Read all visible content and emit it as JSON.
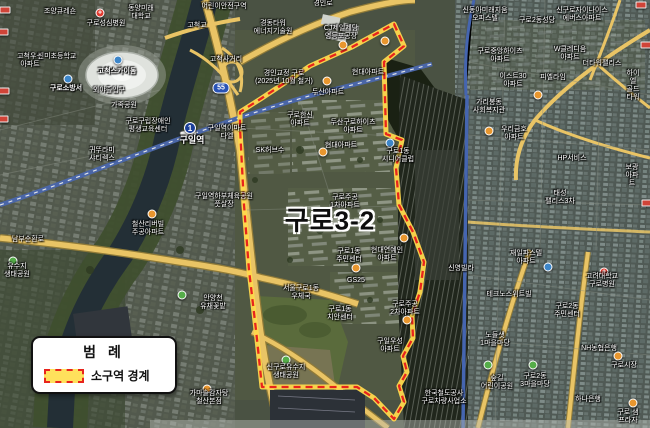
{
  "legend": {
    "title": "범 례",
    "boundary_label": "소구역 경계"
  },
  "map": {
    "area_label": "구로3-2",
    "area_label_pos": {
      "x": 330,
      "y": 219
    },
    "subway_badge": "1",
    "route_badge": "55",
    "hospital_glyph": "+",
    "colors": {
      "boundary_red": "#e8241c",
      "boundary_yellow": "#ffd94d",
      "legend_swatch": "#ffe15c",
      "road_yellow": "#e9c465",
      "railway_blue": "#4a66a8",
      "river": "#232f36"
    },
    "labels": [
      {
        "text": "조양큐레숀",
        "x": 60,
        "y": 8
      },
      {
        "text": "구로성심병원",
        "x": 106,
        "y": 20
      },
      {
        "text": "동양미래\n대학교",
        "x": 141,
        "y": 5
      },
      {
        "text": "고척우성\n아파트",
        "x": 30,
        "y": 53
      },
      {
        "text": "신미초등학교",
        "x": 57,
        "y": 53
      },
      {
        "text": "고척스카이돔",
        "x": 117,
        "y": 68,
        "bold": true
      },
      {
        "text": "구로소방서",
        "x": 66,
        "y": 85,
        "bold": true
      },
      {
        "text": "외야출입구",
        "x": 109,
        "y": 87
      },
      {
        "text": "가족공원",
        "x": 124,
        "y": 102
      },
      {
        "text": "구로구립장애인\n평생교육센터",
        "x": 148,
        "y": 118
      },
      {
        "text": "구일역",
        "x": 192,
        "y": 135,
        "bold": true,
        "size": 9
      },
      {
        "text": "구일역이마트\n다엘",
        "x": 227,
        "y": 125
      },
      {
        "text": "귀뚜라미\n샤티렉스",
        "x": 102,
        "y": 147
      },
      {
        "text": "구일역하부체육공원\n풋살장",
        "x": 224,
        "y": 193
      },
      {
        "text": "남부순환로",
        "x": 28,
        "y": 236
      },
      {
        "text": "유수지\n생태공원",
        "x": 17,
        "y": 263
      },
      {
        "text": "철산리버빌\n주공아파트",
        "x": 148,
        "y": 221
      },
      {
        "text": "안양천\n유채꽃밭",
        "x": 213,
        "y": 295
      },
      {
        "text": "가마솥감자탕\n철산본점",
        "x": 209,
        "y": 390
      },
      {
        "text": "경인로",
        "x": 323,
        "y": 0
      },
      {
        "text": "어린이안전구역",
        "x": 224,
        "y": 3
      },
      {
        "text": "고척교",
        "x": 197,
        "y": 22
      },
      {
        "text": "CJ제일제당\n영등포공장",
        "x": 341,
        "y": 25
      },
      {
        "text": "경동타워\n에너지기술원",
        "x": 273,
        "y": 20
      },
      {
        "text": "고척사거리",
        "x": 226,
        "y": 56
      },
      {
        "text": "경인교정 구로\n(2025년 10월 철거)",
        "x": 284,
        "y": 70
      },
      {
        "text": "두산아파트",
        "x": 328,
        "y": 89
      },
      {
        "text": "구로한신\n아파트",
        "x": 300,
        "y": 112
      },
      {
        "text": "SK허브수",
        "x": 270,
        "y": 147
      },
      {
        "text": "현대아파트",
        "x": 368,
        "y": 69
      },
      {
        "text": "두산구로하이츠\n아파트",
        "x": 353,
        "y": 119
      },
      {
        "text": "현대아파트",
        "x": 341,
        "y": 142
      },
      {
        "text": "구로1동\n시니어클럽",
        "x": 398,
        "y": 148
      },
      {
        "text": "구로주공\n1차아파트",
        "x": 345,
        "y": 194
      },
      {
        "text": "현대연예인\n아파트",
        "x": 387,
        "y": 247
      },
      {
        "text": "구로1동\n주민센터",
        "x": 349,
        "y": 248
      },
      {
        "text": "GS25",
        "x": 356,
        "y": 277
      },
      {
        "text": "서울구로1동\n우체국",
        "x": 301,
        "y": 285
      },
      {
        "text": "구로1동\n치안센터",
        "x": 340,
        "y": 306
      },
      {
        "text": "구로주공\n2차아파트",
        "x": 405,
        "y": 301
      },
      {
        "text": "구일우성\n아파트",
        "x": 390,
        "y": 338
      },
      {
        "text": "신구로유수지\n생태공원",
        "x": 286,
        "y": 364
      },
      {
        "text": "한국철도공사\n구로차량사업소",
        "x": 444,
        "y": 390
      },
      {
        "text": "신동아미래지움\n오피스텔",
        "x": 485,
        "y": 7
      },
      {
        "text": "구로2동성당",
        "x": 537,
        "y": 17
      },
      {
        "text": "신구로자이나이스\n에버스아파트",
        "x": 582,
        "y": 7
      },
      {
        "text": "구로중앙하이츠\n아파트",
        "x": 500,
        "y": 48
      },
      {
        "text": "W클레디움\n아파트",
        "x": 570,
        "y": 46
      },
      {
        "text": "더타워팰리스",
        "x": 602,
        "y": 60
      },
      {
        "text": "하이엘\n골드타워",
        "x": 633,
        "y": 70
      },
      {
        "text": "이스트30\n아파트",
        "x": 513,
        "y": 73
      },
      {
        "text": "피엘라임",
        "x": 553,
        "y": 74
      },
      {
        "text": "가리봉동\n사회복지관",
        "x": 489,
        "y": 99
      },
      {
        "text": "우리금호\n아파트",
        "x": 514,
        "y": 126
      },
      {
        "text": "HP서비스",
        "x": 572,
        "y": 155
      },
      {
        "text": "보광아파트",
        "x": 632,
        "y": 164
      },
      {
        "text": "태성\n팰리스3차",
        "x": 560,
        "y": 190
      },
      {
        "text": "재일파스텔\n아파트",
        "x": 526,
        "y": 250
      },
      {
        "text": "신영빌라",
        "x": 461,
        "y": 265
      },
      {
        "text": "고려대학교\n구로병원",
        "x": 602,
        "y": 273
      },
      {
        "text": "테크노스위트빌",
        "x": 509,
        "y": 291
      },
      {
        "text": "구로2동\n주민센터",
        "x": 567,
        "y": 303
      },
      {
        "text": "노들샛\n1마을마당",
        "x": 495,
        "y": 332
      },
      {
        "text": "NH농협은행",
        "x": 599,
        "y": 345
      },
      {
        "text": "구로시장",
        "x": 624,
        "y": 362
      },
      {
        "text": "구로2동\n3마을마당",
        "x": 535,
        "y": 373
      },
      {
        "text": "숲길\n어린이공원",
        "x": 497,
        "y": 375
      },
      {
        "text": "하나은행",
        "x": 588,
        "y": 396
      },
      {
        "text": "구로 샘프라자",
        "x": 628,
        "y": 409
      }
    ],
    "markers": [
      {
        "type": "hospital",
        "x": 100,
        "y": 13
      },
      {
        "type": "hospital",
        "x": 604,
        "y": 272
      },
      {
        "type": "subway",
        "x": 190,
        "y": 128
      },
      {
        "type": "route",
        "x": 221,
        "y": 88
      },
      {
        "type": "orange",
        "x": 152,
        "y": 214
      },
      {
        "type": "orange",
        "x": 207,
        "y": 389
      },
      {
        "type": "orange",
        "x": 343,
        "y": 45
      },
      {
        "type": "orange",
        "x": 385,
        "y": 41
      },
      {
        "type": "orange",
        "x": 327,
        "y": 81
      },
      {
        "type": "orange",
        "x": 323,
        "y": 152
      },
      {
        "type": "orange",
        "x": 356,
        "y": 268
      },
      {
        "type": "orange",
        "x": 404,
        "y": 238
      },
      {
        "type": "orange",
        "x": 407,
        "y": 320
      },
      {
        "type": "orange",
        "x": 489,
        "y": 131
      },
      {
        "type": "orange",
        "x": 538,
        "y": 95
      },
      {
        "type": "orange",
        "x": 618,
        "y": 356
      },
      {
        "type": "orange",
        "x": 633,
        "y": 403
      },
      {
        "type": "green",
        "x": 13,
        "y": 261
      },
      {
        "type": "green",
        "x": 182,
        "y": 295
      },
      {
        "type": "green",
        "x": 286,
        "y": 360
      },
      {
        "type": "green",
        "x": 488,
        "y": 365
      },
      {
        "type": "green",
        "x": 533,
        "y": 365
      },
      {
        "type": "blue",
        "x": 118,
        "y": 60
      },
      {
        "type": "blue",
        "x": 68,
        "y": 79
      },
      {
        "type": "blue",
        "x": 390,
        "y": 143
      },
      {
        "type": "blue",
        "x": 548,
        "y": 267
      },
      {
        "type": "sign",
        "x": 5,
        "y": 10
      },
      {
        "type": "sign",
        "x": 3,
        "y": 32
      },
      {
        "type": "sign",
        "x": 4,
        "y": 91
      },
      {
        "type": "sign",
        "x": 3,
        "y": 119
      },
      {
        "type": "sign",
        "x": 641,
        "y": 5
      },
      {
        "type": "sign",
        "x": 646,
        "y": 45
      },
      {
        "type": "sign",
        "x": 647,
        "y": 203
      }
    ]
  }
}
